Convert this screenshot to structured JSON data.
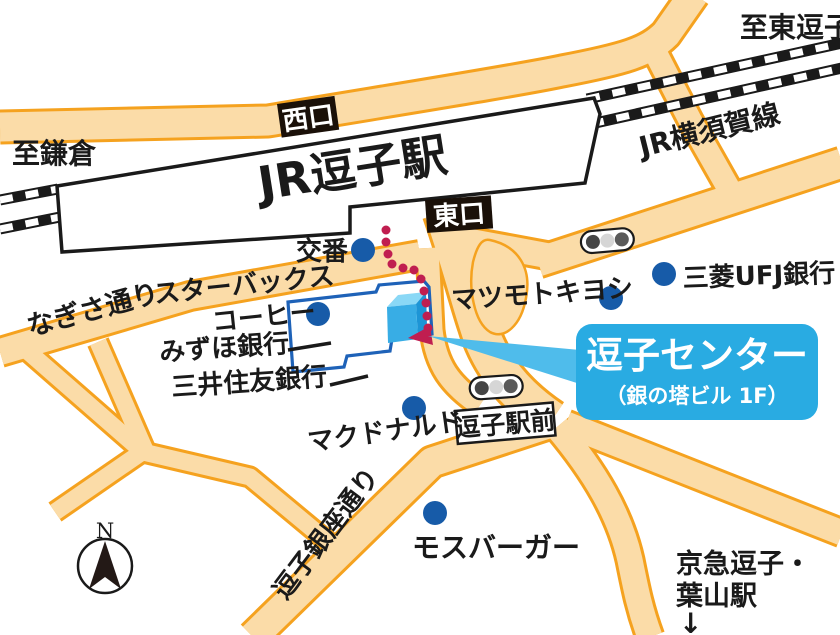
{
  "map": {
    "station": {
      "name": "JR逗子駅",
      "west_exit": "西口",
      "east_exit": "東口"
    },
    "rail": {
      "line_name": "JR横須賀線"
    },
    "directions": {
      "higashi_zushi": "至東逗子",
      "kamakura": "至鎌倉",
      "keikyu_line1": "京急逗子・",
      "keikyu_line2": "葉山駅",
      "keikyu_arrow": "↓"
    },
    "streets": {
      "nagisa": "なぎさ通り",
      "ginza": "逗子銀座通り",
      "ekimae_badge": "逗子駅前"
    },
    "pois": {
      "koban": "交番",
      "starbucks_line1": "スターバックス",
      "starbucks_line2": "コーヒー",
      "mizuho": "みずほ銀行",
      "smbc": "三井住友銀行",
      "matsumotokiyoshi": "マツモトキヨシ",
      "mufg": "三菱UFJ銀行",
      "mcdonalds": "マクドナルド",
      "mosburger": "モスバーガー"
    },
    "destination": {
      "title": "逗子センター",
      "subtitle": "（銀の塔ビル 1F）"
    },
    "compass": {
      "north": "N"
    },
    "colors": {
      "road_fill": "#FBDCA8",
      "road_border": "#F5A21F",
      "poi_dot": "#175BA8",
      "building_outline": "#1E62B8",
      "station_outline": "#1A1A1A",
      "callout_bg": "#29ABE2",
      "callout_pointer": "#4FBCEB",
      "route_dot": "#C01E50",
      "cube_top": "#8AD8F6",
      "cube_front": "#38ADE5",
      "cube_side": "#1D95D6"
    }
  }
}
